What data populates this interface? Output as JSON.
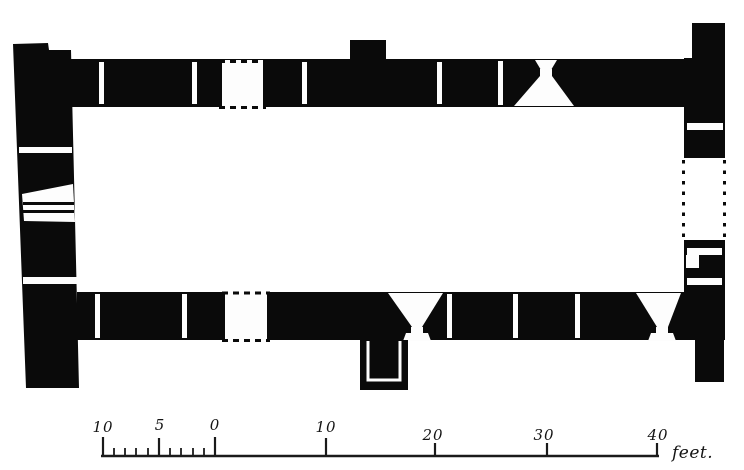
{
  "figure": {
    "kind": "hand-drawn architectural floor plan (scanned line engraving)",
    "paper_color": "#ffffff",
    "ink_color": "#0a0a0a",
    "description": "Rectangular single-cell building shown in plan with solid black walls; narrow window slits, inward-splayed windows, blocked doorways drawn with dashed lines on north and south walls, a dashed opening at the east end, and a small projecting structure on the south side"
  },
  "scale_bar": {
    "major_labels": [
      {
        "text": "10",
        "value": -10
      },
      {
        "text": "5",
        "value": -5
      },
      {
        "text": "0",
        "value": 0
      },
      {
        "text": "10",
        "value": 10
      },
      {
        "text": "20",
        "value": 20
      },
      {
        "text": "30",
        "value": 30
      },
      {
        "text": "40",
        "value": 40
      }
    ],
    "unit_label": "feet."
  }
}
